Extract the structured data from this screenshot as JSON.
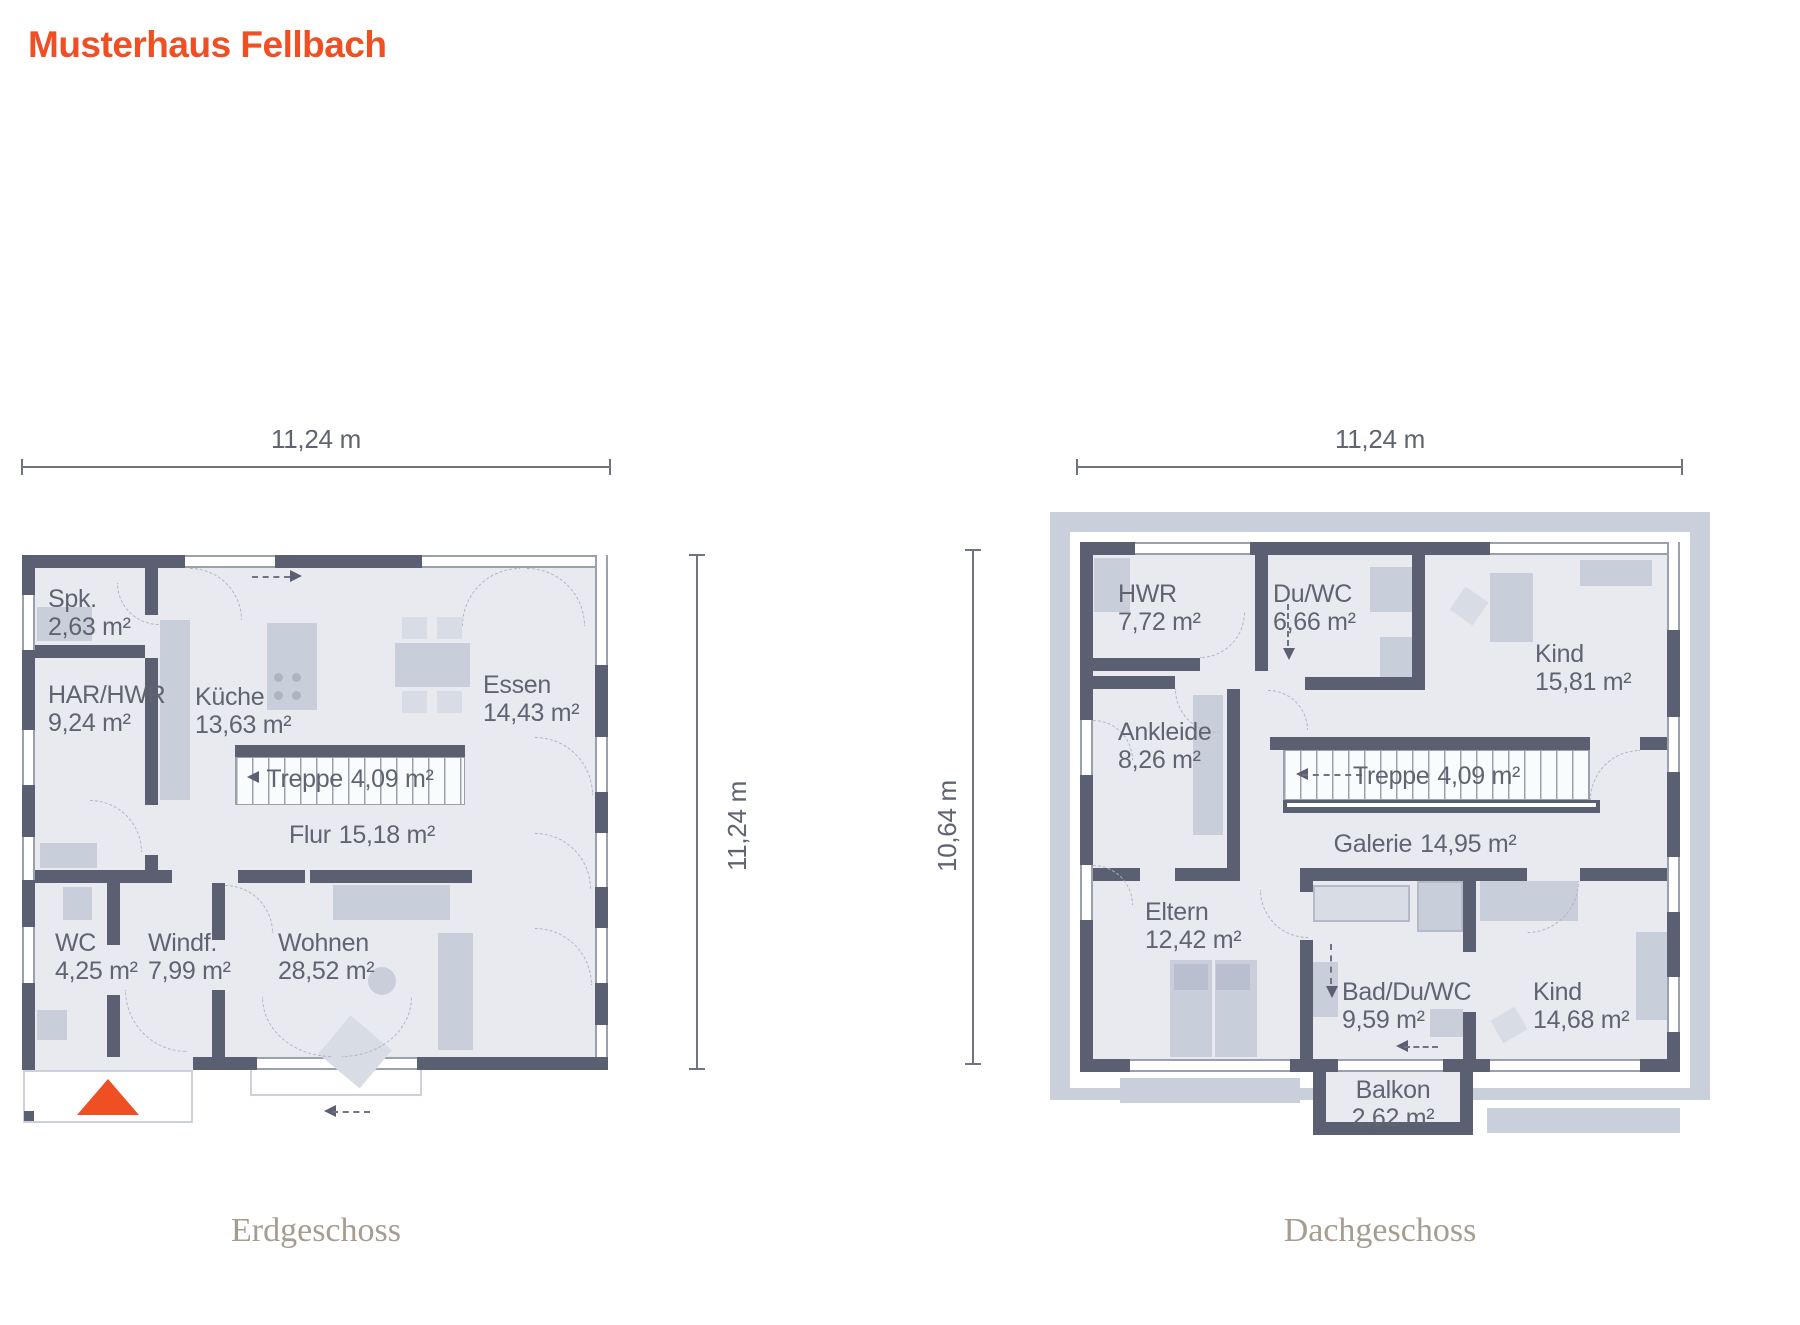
{
  "title": "Musterhaus Fellbach",
  "floors": [
    {
      "caption": "Erdgeschoss",
      "width_label": "11,24 m",
      "height_label": "11,24 m",
      "rooms": [
        {
          "name": "Spk.",
          "area": "2,63 m²"
        },
        {
          "name": "HAR/HWR",
          "area": "9,24 m²"
        },
        {
          "name": "Küche",
          "area": "13,63 m²"
        },
        {
          "name": "Essen",
          "area": "14,43 m²"
        },
        {
          "name": "Treppe",
          "area": "4,09 m²"
        },
        {
          "name": "Flur",
          "area": "15,18 m²"
        },
        {
          "name": "WC",
          "area": "4,25 m²"
        },
        {
          "name": "Windf.",
          "area": "7,99 m²"
        },
        {
          "name": "Wohnen",
          "area": "28,52 m²"
        }
      ]
    },
    {
      "caption": "Dachgeschoss",
      "width_label": "11,24 m",
      "height_label": "10,64 m",
      "rooms": [
        {
          "name": "HWR",
          "area": "7,72 m²"
        },
        {
          "name": "Du/WC",
          "area": "6,66 m²"
        },
        {
          "name": "Kind",
          "area": "15,81 m²"
        },
        {
          "name": "Ankleide",
          "area": "8,26 m²"
        },
        {
          "name": "Treppe",
          "area": "4,09 m²"
        },
        {
          "name": "Galerie",
          "area": "14,95 m²"
        },
        {
          "name": "Eltern",
          "area": "12,42 m²"
        },
        {
          "name": "Bad/Du/WC",
          "area": "9,59 m²"
        },
        {
          "name": "Kind",
          "area": "14,68 m²"
        },
        {
          "name": "Balkon",
          "area": "2,62 m²"
        }
      ]
    }
  ],
  "colors": {
    "accent": "#f04e23",
    "wall": "#5b5f72",
    "floor": "#e9eaf0",
    "roof": "#c9cfdb",
    "furniture": "#c9cedb",
    "furniture_light": "#d8dce5",
    "outline": "#9aa0ad",
    "dashed_line": "#b0b5c0",
    "label_text": "#5f6470",
    "caption_text": "#a69d90",
    "dimension": "#6f7480"
  }
}
